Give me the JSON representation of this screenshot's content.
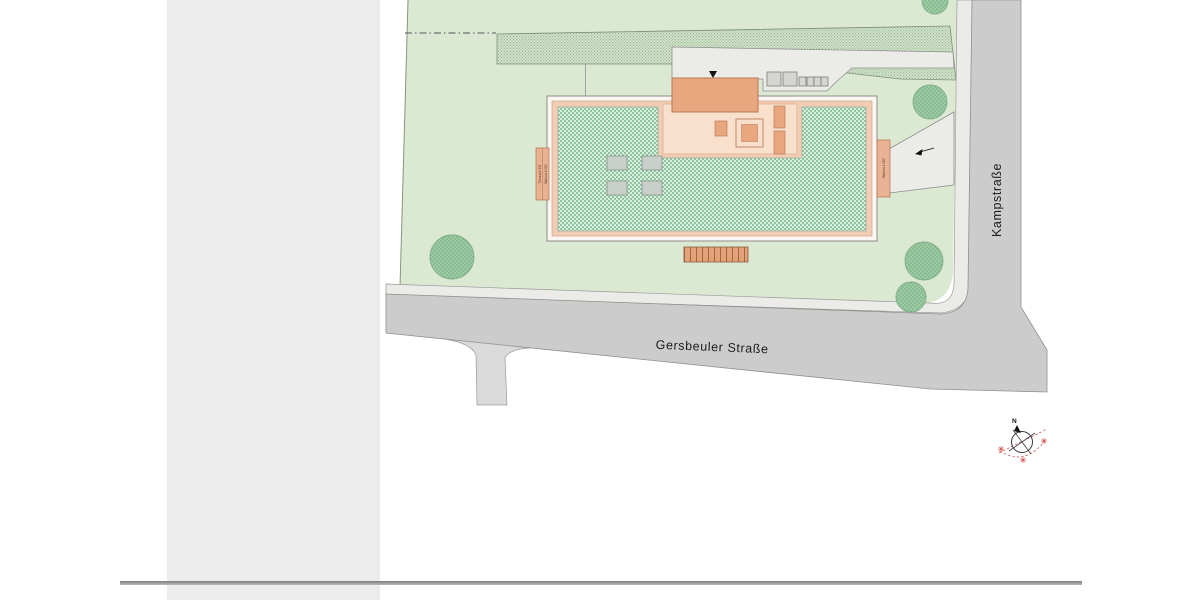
{
  "window": {
    "background": "#ffffff"
  },
  "left_panel": {
    "background": "#ececec"
  },
  "divider": {
    "color": "#8a8a8a"
  },
  "site_plan": {
    "streets": {
      "gersbeuler": "Gersbeuler Straße",
      "kampstrasse": "Kampstraße"
    },
    "compass": {
      "north": "N"
    },
    "building_annotations": {
      "left_strip_line1": "Terrasse EG",
      "left_strip_line2": "Balkon 1.OG",
      "right_strip": "Balkon 1.OG"
    },
    "colors": {
      "plot_green": "#dbe8d2",
      "roof_green": "#a9d4b2",
      "hedge_green": "#c6d9bf",
      "tree_green": "#9ccaa3",
      "building_salmon": "#e9a77f",
      "building_pink_band": "#f2cdb5",
      "courtyard_salmon": "#f8e0cd",
      "street_gray": "#cccccc",
      "sidewalk_gray": "#ebebe8",
      "compass_red": "#cc4545"
    }
  }
}
